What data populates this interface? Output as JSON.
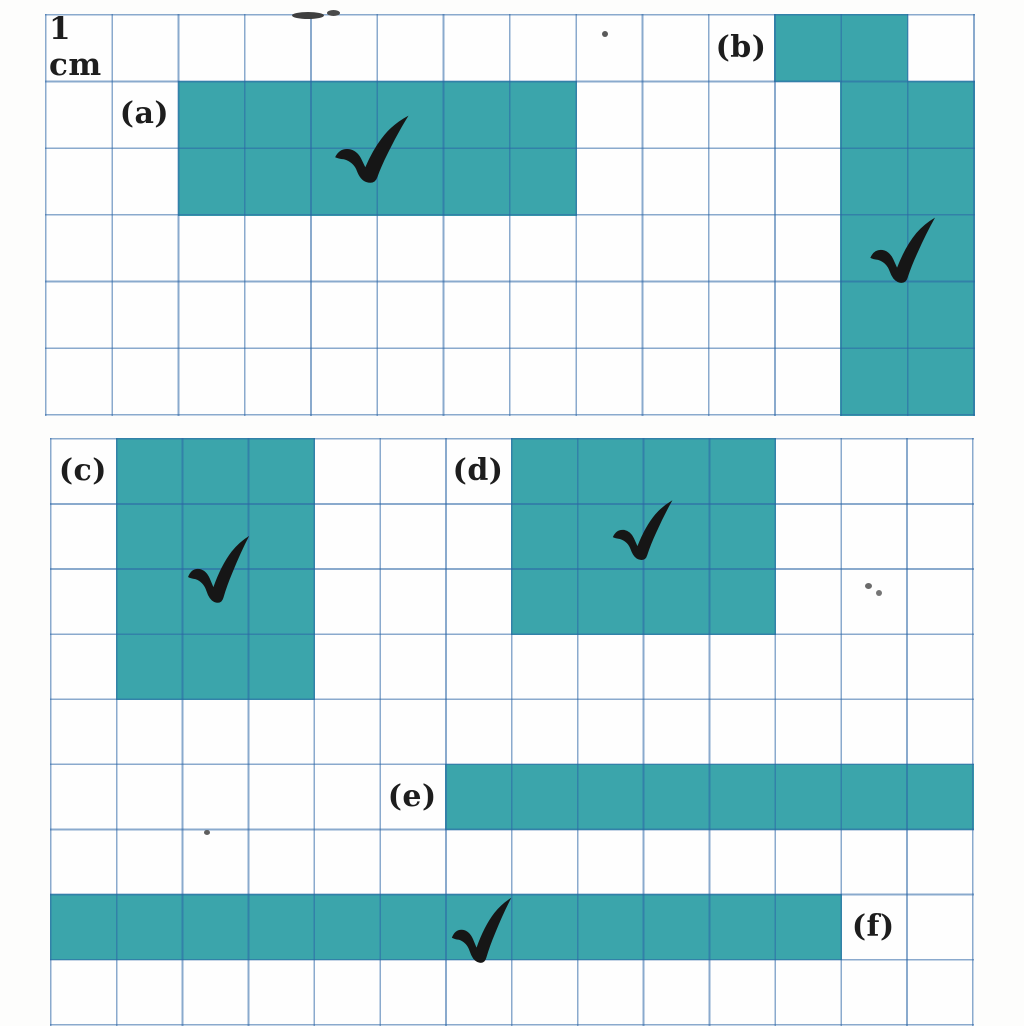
{
  "page_title": "centimetre grid worksheet",
  "unit_label": "1 cm",
  "colors": {
    "shape_fill": "#3ba5ab",
    "grid_line_rgba": "rgba(42,100,165,0.55)",
    "checkmark": "#161616",
    "label_text": "#1d1d1d",
    "paper": "#fdfdfc"
  },
  "grids": [
    {
      "id": "top",
      "cols": 14,
      "rows": 6,
      "cell_w": 66.29,
      "cell_h": 66.67,
      "frame": {
        "left": 45,
        "top": 14
      },
      "labels": [
        {
          "id": "unit",
          "text": "1 cm",
          "col": 0,
          "row": 0,
          "align": "left"
        },
        {
          "id": "a",
          "text": "(a)",
          "col": 1,
          "row": 1
        },
        {
          "id": "b",
          "text": "(b)",
          "col": 10,
          "row": 0
        }
      ],
      "shapes": [
        {
          "name": "a",
          "cells": 12,
          "rects": [
            {
              "col": 2,
              "row": 1,
              "w": 6,
              "h": 2
            }
          ]
        },
        {
          "name": "b",
          "cells": 12,
          "rects": [
            {
              "col": 11,
              "row": 0,
              "w": 2,
              "h": 1
            },
            {
              "col": 12,
              "row": 1,
              "w": 2,
              "h": 5
            }
          ]
        }
      ]
    },
    {
      "id": "bottom",
      "cols": 14,
      "rows": 9,
      "cell_w": 65.86,
      "cell_h": 65.1,
      "frame": {
        "left": 50,
        "top": 438
      },
      "labels": [
        {
          "id": "c",
          "text": "(c)",
          "col": 0,
          "row": 0
        },
        {
          "id": "d",
          "text": "(d)",
          "col": 6,
          "row": 0
        },
        {
          "id": "e",
          "text": "(e)",
          "col": 5,
          "row": 5
        },
        {
          "id": "f",
          "text": "(f)",
          "col": 12,
          "row": 7
        }
      ],
      "shapes": [
        {
          "name": "c",
          "cells": 12,
          "rects": [
            {
              "col": 1,
              "row": 0,
              "w": 3,
              "h": 4
            }
          ]
        },
        {
          "name": "d",
          "cells": 12,
          "rects": [
            {
              "col": 7,
              "row": 0,
              "w": 4,
              "h": 3
            }
          ]
        },
        {
          "name": "e",
          "cells": 8,
          "rects": [
            {
              "col": 6,
              "row": 5,
              "w": 8,
              "h": 1
            }
          ]
        },
        {
          "name": "f",
          "cells": 12,
          "rects": [
            {
              "col": 0,
              "row": 7,
              "w": 12,
              "h": 1
            }
          ]
        }
      ]
    }
  ],
  "checkmarks": [
    {
      "shape": "a",
      "x": 328,
      "y": 111,
      "w": 86,
      "h": 74
    },
    {
      "shape": "b",
      "x": 864,
      "y": 213,
      "w": 76,
      "h": 72
    },
    {
      "shape": "c",
      "x": 182,
      "y": 531,
      "w": 72,
      "h": 74
    },
    {
      "shape": "d",
      "x": 607,
      "y": 496,
      "w": 70,
      "h": 66
    },
    {
      "shape": "f",
      "x": 446,
      "y": 893,
      "w": 70,
      "h": 72
    }
  ],
  "artifacts": [
    {
      "x": 292,
      "y": 12,
      "w": 32,
      "h": 7,
      "c": "#3f3f3f"
    },
    {
      "x": 327,
      "y": 10,
      "w": 13,
      "h": 6,
      "c": "#4a4a4a"
    },
    {
      "x": 602,
      "y": 31,
      "w": 6,
      "h": 6,
      "c": "#5a5a5a"
    },
    {
      "x": 865,
      "y": 583,
      "w": 7,
      "h": 6,
      "c": "#6a6a6a"
    },
    {
      "x": 876,
      "y": 590,
      "w": 6,
      "h": 6,
      "c": "#757575"
    },
    {
      "x": 204,
      "y": 830,
      "w": 6,
      "h": 5,
      "c": "#5f5f5f"
    }
  ]
}
